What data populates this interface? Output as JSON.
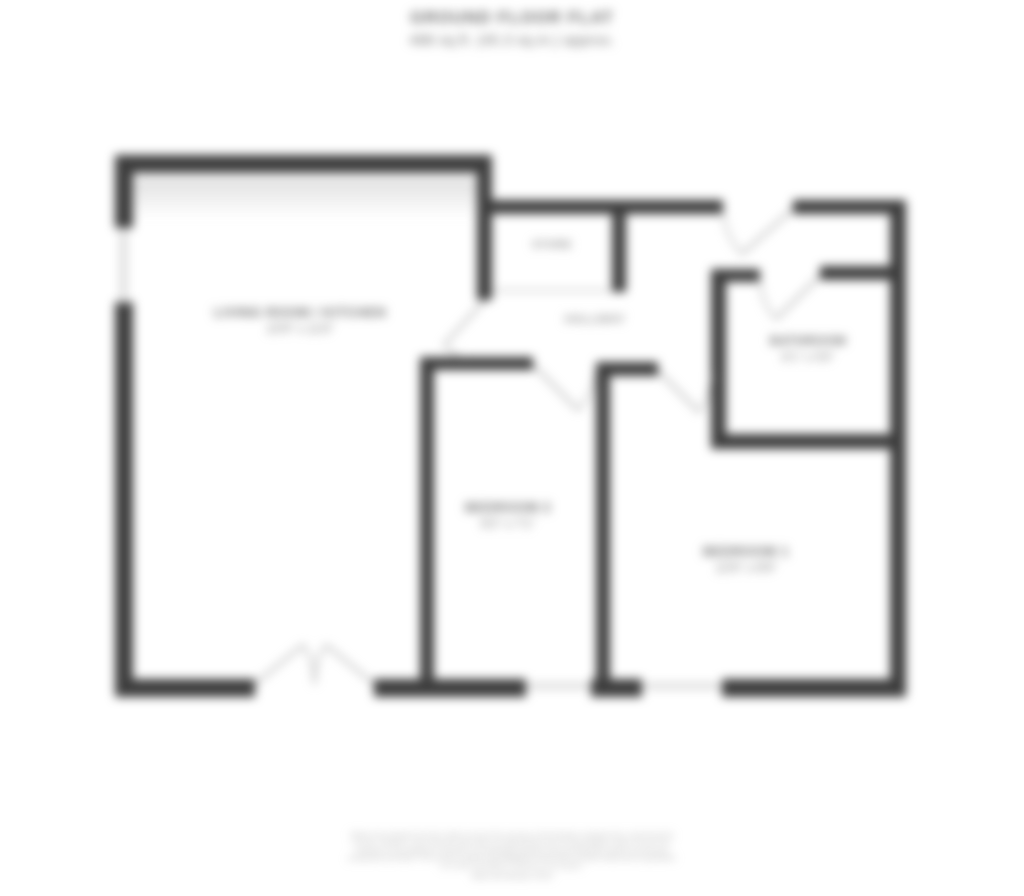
{
  "header": {
    "floor_label": "GROUND FLOOR FLAT",
    "area_label": "488 sq.ft. (45.3 sq.m.) approx."
  },
  "rooms": {
    "living": {
      "name": "LIVING ROOM / KITCHEN",
      "dims": "15'9\" x 11'6\""
    },
    "hallway": {
      "name": "HALLWAY"
    },
    "store": {
      "name": "STORE"
    },
    "bathroom": {
      "name": "BATHROOM",
      "dims": "6'1\" x 5'6\""
    },
    "bedroom_middle": {
      "name": "BEDROOM 2",
      "dims": "9'2\" x 7'1\""
    },
    "bedroom_right": {
      "name": "BEDROOM 1",
      "dims": "12'6\" x 8'9\""
    }
  },
  "footer": {
    "lines": [
      "Whilst every attempt has been made to ensure the accuracy of the floorplan contained here, measurements",
      "of doors, windows, rooms and any other items are approximate and no responsibility is taken for any error,",
      "omission or mis-statement. This plan is for illustrative purposes only and should be used as such by any",
      "prospective purchaser. The services, systems and appliances shown have not been tested and no guarantee",
      "as to their operability or efficiency can be given."
    ],
    "credit": "Made with Metropix ©2024"
  },
  "colors": {
    "wall": "#3d3d3d",
    "label_text": "#6e6e6e",
    "faint_text": "#9c9c9c",
    "door_swing": "#b5b5b5",
    "window": "#d9d9d9",
    "counter_band": "#e0e0e0",
    "background": "#ffffff"
  }
}
